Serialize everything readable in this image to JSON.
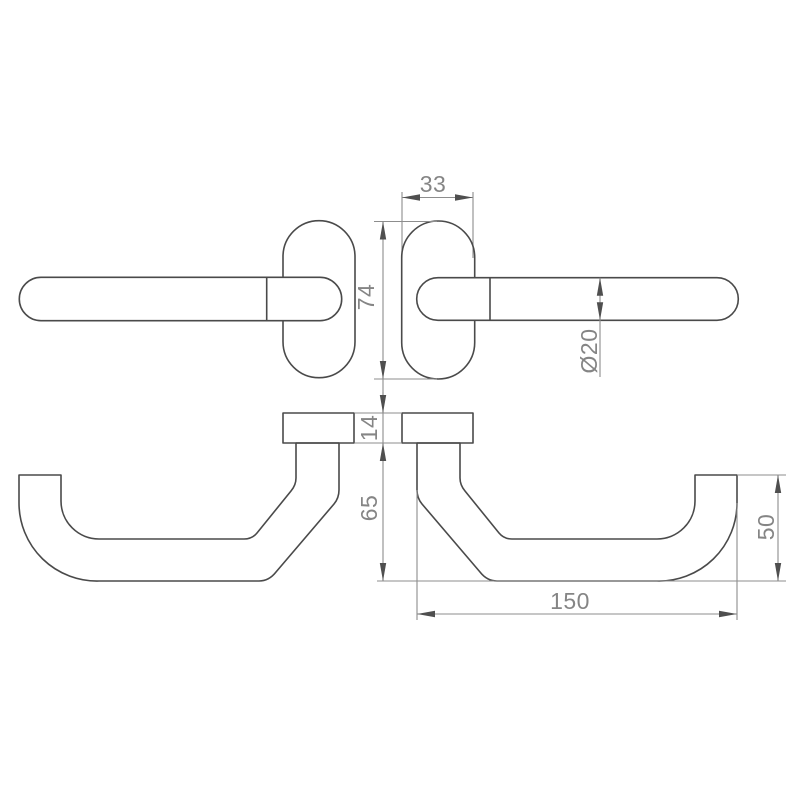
{
  "drawing": {
    "type": "technical-drawing",
    "subject": "door lever handle with oval rose, plan and front views, mirrored pair",
    "background_color": "#ffffff",
    "line_color": "#4a4a4a",
    "dimension_line_color": "#8d8d8d",
    "dimension_text_color": "#858585",
    "dimensions": {
      "rose_width": {
        "label": "33",
        "meaning": "rose width (top view)"
      },
      "rose_height": {
        "label": "74",
        "meaning": "rose height (top view)"
      },
      "lever_diameter": {
        "label": "Ø20",
        "meaning": "lever tube diameter"
      },
      "rose_thickness": {
        "label": "14",
        "meaning": "rose thickness (front view)"
      },
      "handle_drop": {
        "label": "65",
        "meaning": "drop below rose (front view)"
      },
      "grip_end_height": {
        "label": "50",
        "meaning": "upturned grip end height"
      },
      "handle_length": {
        "label": "150",
        "meaning": "overall handle length"
      }
    }
  }
}
